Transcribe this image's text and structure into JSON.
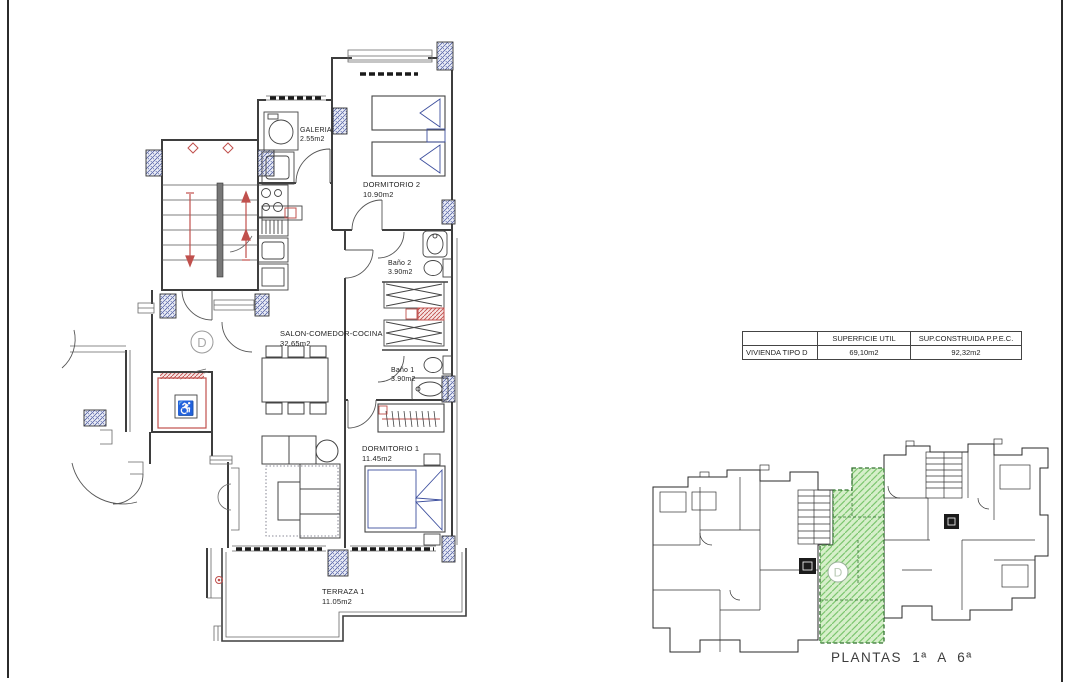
{
  "floor_plan": {
    "unit_label": "D",
    "rooms": [
      {
        "name": "GALERIA",
        "area": "2.55m2"
      },
      {
        "name": "DORMITORIO 2",
        "area": "10.90m2"
      },
      {
        "name": "Baño 2",
        "area": "3.90m2"
      },
      {
        "name": "SALON-COMEDOR-COCINA",
        "area": "32.65m2"
      },
      {
        "name": "Baño 1",
        "area": "3.90m2"
      },
      {
        "name": "DORMITORIO 1",
        "area": "11.45m2"
      },
      {
        "name": "TERRAZA 1",
        "area": "11.05m2"
      }
    ]
  },
  "info_table": {
    "headers": [
      "",
      "SUPERFICIE UTIL",
      "SUP.CONSTRUIDA P.P.E.C."
    ],
    "rows": [
      {
        "label": "VIVIENDA TIPO D",
        "superficie_util": "69,10m2",
        "sup_construida": "92,32m2"
      }
    ]
  },
  "key_plan": {
    "unit_label": "D",
    "caption": "PLANTAS 1ª A 6ª"
  },
  "colors": {
    "wall": "#3e3e3e",
    "furniture_blue": "#3d4f9e",
    "accent_red": "#c0504d",
    "column_hatch_blue": "#3f4e9c",
    "highlight_green_fill": "#d6efca",
    "highlight_green_hatch": "#7cc66f",
    "highlight_green_border": "#31702e"
  }
}
